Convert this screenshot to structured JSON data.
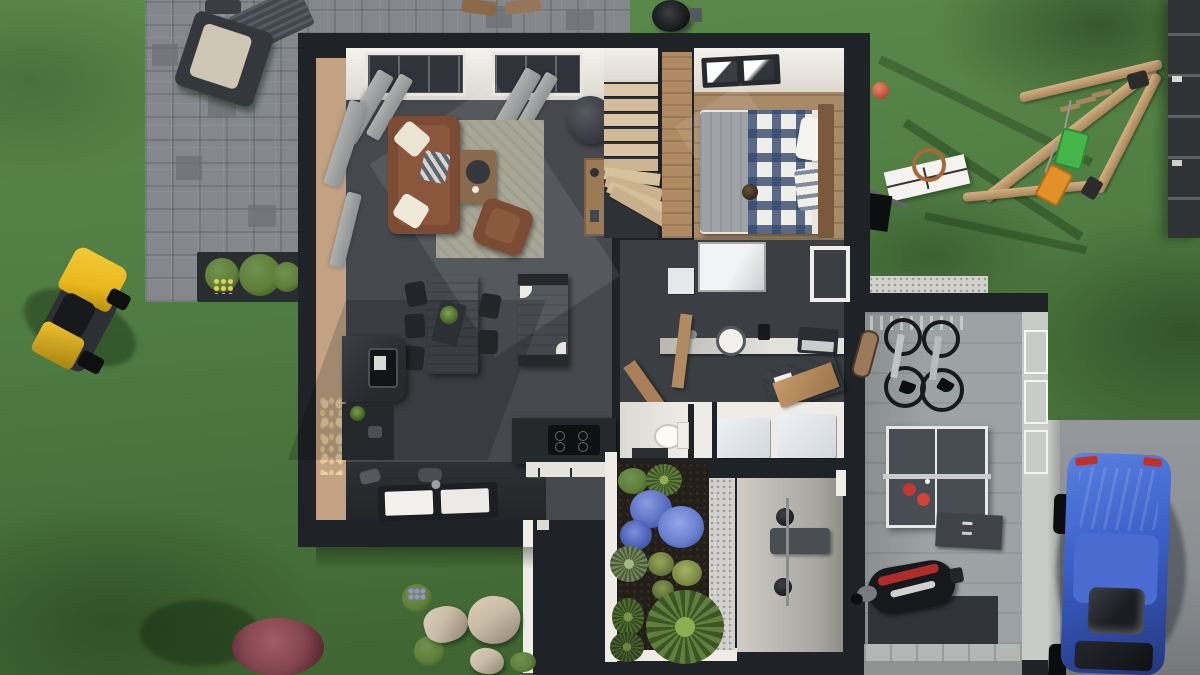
{
  "scene": {
    "type": "3d-top-down-floorplan-render",
    "rooms": [
      "living-room",
      "dining-area",
      "kitchen",
      "staircase",
      "bedroom",
      "office",
      "bathroom-laundry",
      "entry-hall",
      "garage",
      "patio-courtyard"
    ],
    "yard_objects": [
      "stone-patio",
      "outdoor-armchair",
      "outdoor-table",
      "bbq-grill",
      "planter-box",
      "riding-lawn-mower",
      "swing-set",
      "basketball-hoop",
      "red-ball",
      "fence",
      "driveway",
      "blue-car",
      "red-bush",
      "rocks",
      "green-bushes"
    ],
    "interior_objects": [
      "sofa",
      "pillows",
      "rug",
      "coffee-table",
      "ottoman",
      "armchair",
      "dining-table",
      "chairs",
      "sideboard",
      "stove",
      "kitchen-counter",
      "double-sink",
      "island-cooktop",
      "stairs",
      "double-bed",
      "plaid-bedding",
      "headboard",
      "skylight",
      "desk",
      "laptop",
      "wall-clock",
      "fold-out-desk",
      "toilet",
      "washer",
      "dryer",
      "bench",
      "coat-rack",
      "bicycles",
      "skateboard",
      "ping-pong-table",
      "paddles",
      "scooter",
      "wall-cabinet"
    ],
    "palette": {
      "grass": "#4e7b41",
      "grass_light": "#5c8a4c",
      "grass_dark": "#3c612f",
      "patio": "#84888d",
      "wall": "#1f2227",
      "floor_dark": "#45484d",
      "wall_tan": "#c2a283",
      "white_wall": "#efece7",
      "wood": "#a98a66",
      "wood_light": "#d8c2a3",
      "rug": "#a8a697",
      "sofa": "#7c4b33",
      "bed_navy": "#34496e",
      "duvet_gray": "#9fa3a8",
      "garage_floor": "#9da2a4",
      "garage_wall": "#c8cbc8",
      "driveway": "#8b8f92",
      "soil": "#241e19",
      "gravel": "#d3d1cd",
      "mower_yellow": "#e9b91d",
      "car_blue": "#3a5fc8",
      "swing_green": "#45b54a",
      "swing_orange": "#e2902a",
      "ball_red": "#c65a3e",
      "hydrangea": "#5a6fc2",
      "plant_green": "#5f7f3a",
      "bush_red": "#84454f",
      "rock": "#c9bca7",
      "pingpong": "#474d52",
      "paddle_red": "#c23832",
      "curtain": "#aeb1b0"
    }
  }
}
